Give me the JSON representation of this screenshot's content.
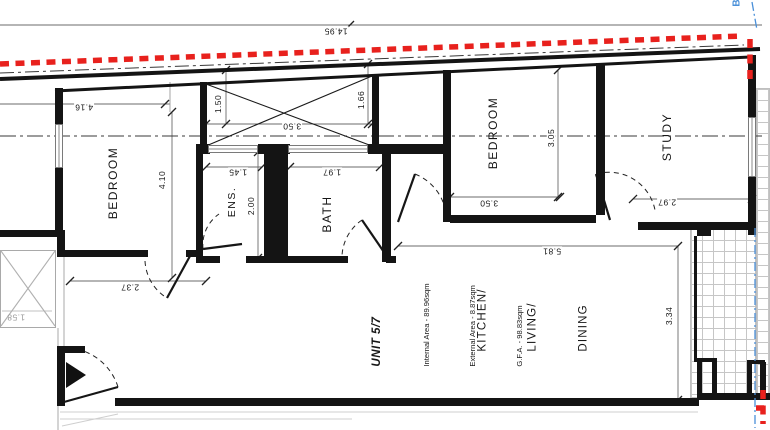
{
  "title": "Unit 5/7 floor plan",
  "unit": {
    "name": "UNIT 5/7",
    "internal_area": "Internal Area - 89.96sqm",
    "external_area": "External Area - 8.87sqm",
    "gfa": "G.F.A. - 98.83sqm"
  },
  "rooms": {
    "bedroom1": "BEDROOM",
    "ens": "ENS.",
    "bath": "BATH",
    "bedroom2": "BEDROOM",
    "study": "STUDY",
    "kitchen_lines": [
      "KITCHEN/",
      "LIVING/",
      "DINING"
    ]
  },
  "dims": {
    "overall_width": "14.95",
    "bedroom1_width": "4.16",
    "bedroom1_height": "4.10",
    "shaft_left": "1.50",
    "shaft_right": "1.66",
    "shaft_width": "3.50",
    "ens_width": "1.45",
    "ens_height": "2.00",
    "bath_width": "1.97",
    "bedroom2_height": "3.05",
    "bedroom2_width": "3.50",
    "study_width": "2.97",
    "kitchen_width": "5.81",
    "hall_width": "2.37",
    "kitchen_height": "3.34",
    "stair_shaft": "1.58"
  },
  "markers": {
    "section": "B"
  },
  "colors": {
    "boundary_red": "#e8211d",
    "section_blue": "#4a90d9",
    "shaft_grey": "#a9a9a9"
  }
}
